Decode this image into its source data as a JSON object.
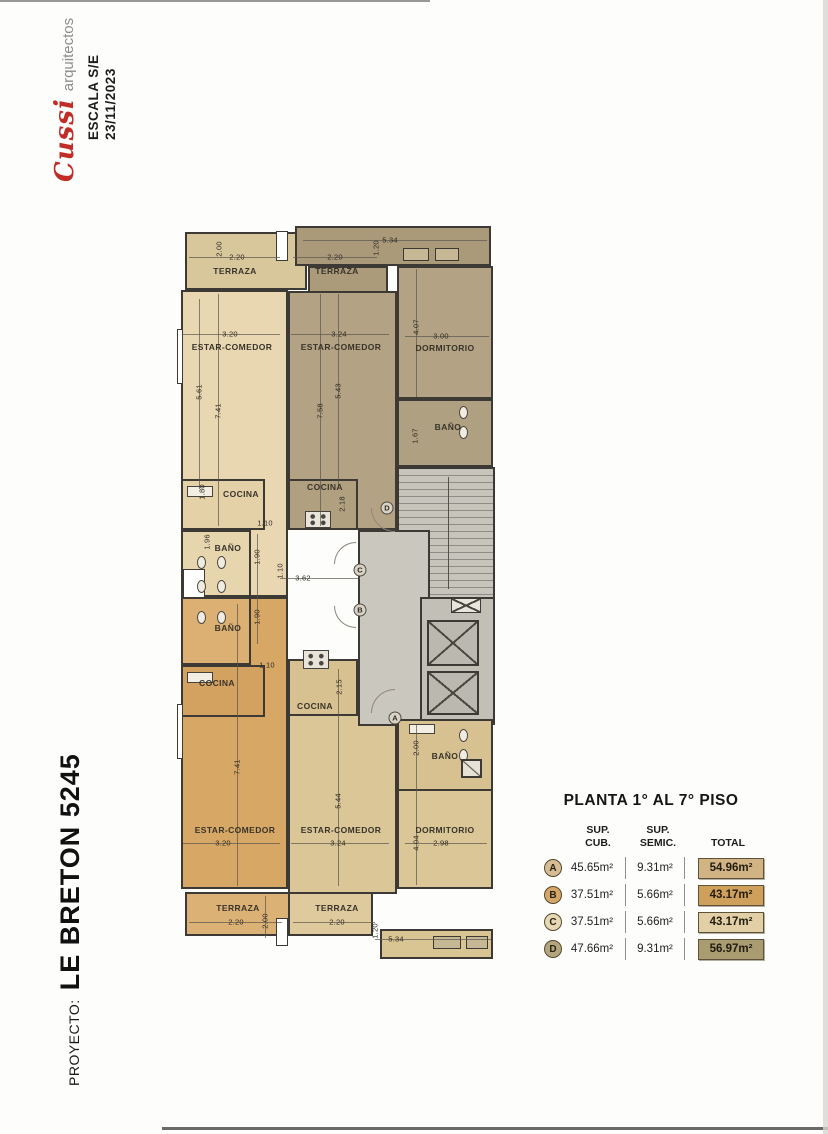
{
  "sidebar": {
    "firm_script": "Cussi",
    "firm_sub": "arquitectos",
    "scale": "ESCALA S/E",
    "date": "23/11/2023",
    "project_label": "PROYECTO:",
    "project_name": "LE BRETON 5245"
  },
  "summary": {
    "title": "PLANTA 1° AL 7° PISO",
    "col_headers": [
      "SUP.\nCUB.",
      "SUP.\nSEMIC.",
      "TOTAL"
    ],
    "rows": [
      {
        "unit": "A",
        "cub": "45.65m²",
        "semic": "9.31m²",
        "total": "54.96m²",
        "box_color": "#d2b384",
        "circle_color": "#d6bc92"
      },
      {
        "unit": "B",
        "cub": "37.51m²",
        "semic": "5.66m²",
        "total": "43.17m²",
        "box_color": "#cfa05b",
        "circle_color": "#d4a768"
      },
      {
        "unit": "C",
        "cub": "37.51m²",
        "semic": "5.66m²",
        "total": "43.17m²",
        "box_color": "#e2cfa6",
        "circle_color": "#e7d8b4"
      },
      {
        "unit": "D",
        "cub": "47.66m²",
        "semic": "9.31m²",
        "total": "56.97m²",
        "box_color": "#a99c71",
        "circle_color": "#b3a67e"
      }
    ]
  },
  "plan": {
    "unit_colors": {
      "A": "#dbc697",
      "B": "#d7a765",
      "C": "#e9d7b2",
      "D": "#b3a283",
      "common": "#cac7bf"
    },
    "labels": [
      {
        "t": "2.00",
        "x": 44,
        "y": 25,
        "v": 1
      },
      {
        "t": "2.20",
        "x": 62,
        "y": 33
      },
      {
        "t": "TERRAZA",
        "x": 60,
        "y": 47,
        "r": 1
      },
      {
        "t": "3.20",
        "x": 55,
        "y": 110
      },
      {
        "t": "ESTAR-COMEDOR",
        "x": 57,
        "y": 123,
        "r": 1
      },
      {
        "t": "5.61",
        "x": 24,
        "y": 168,
        "v": 1
      },
      {
        "t": "7.41",
        "x": 43,
        "y": 187,
        "v": 1
      },
      {
        "t": "1.80",
        "x": 27,
        "y": 268,
        "v": 1
      },
      {
        "t": "COCINA",
        "x": 66,
        "y": 270,
        "r": 1
      },
      {
        "t": "1.10",
        "x": 90,
        "y": 299
      },
      {
        "t": "1.96",
        "x": 32,
        "y": 318,
        "v": 1
      },
      {
        "t": "BAÑO",
        "x": 53,
        "y": 324,
        "r": 1
      },
      {
        "t": "1.90",
        "x": 82,
        "y": 333,
        "v": 1
      },
      {
        "t": "5.34",
        "x": 215,
        "y": 16
      },
      {
        "t": "1.20",
        "x": 201,
        "y": 24,
        "v": 1
      },
      {
        "t": "2.20",
        "x": 160,
        "y": 33
      },
      {
        "t": "TERRAZA",
        "x": 162,
        "y": 47,
        "r": 1
      },
      {
        "t": "3.24",
        "x": 164,
        "y": 110
      },
      {
        "t": "ESTAR-COMEDOR",
        "x": 166,
        "y": 123,
        "r": 1
      },
      {
        "t": "5.43",
        "x": 163,
        "y": 167,
        "v": 1
      },
      {
        "t": "7.58",
        "x": 145,
        "y": 187,
        "v": 1
      },
      {
        "t": "4.07",
        "x": 241,
        "y": 103,
        "v": 1
      },
      {
        "t": "3.00",
        "x": 266,
        "y": 112
      },
      {
        "t": "DORMITORIO",
        "x": 270,
        "y": 124,
        "r": 1
      },
      {
        "t": "1.67",
        "x": 240,
        "y": 212,
        "v": 1
      },
      {
        "t": "BAÑO",
        "x": 273,
        "y": 203,
        "r": 1
      },
      {
        "t": "COCINA",
        "x": 150,
        "y": 263,
        "r": 1
      },
      {
        "t": "2.18",
        "x": 167,
        "y": 280,
        "v": 1
      },
      {
        "t": "1.10",
        "x": 105,
        "y": 347,
        "v": 1
      },
      {
        "t": "3.62",
        "x": 128,
        "y": 354
      },
      {
        "t": "1.90",
        "x": 82,
        "y": 393,
        "v": 1
      },
      {
        "t": "BAÑO",
        "x": 53,
        "y": 404,
        "r": 1
      },
      {
        "t": "1.10",
        "x": 92,
        "y": 441
      },
      {
        "t": "COCINA",
        "x": 42,
        "y": 459,
        "r": 1
      },
      {
        "t": "7.41",
        "x": 62,
        "y": 543,
        "v": 1
      },
      {
        "t": "ESTAR-COMEDOR",
        "x": 60,
        "y": 606,
        "r": 1
      },
      {
        "t": "3.20",
        "x": 48,
        "y": 619
      },
      {
        "t": "TERRAZA",
        "x": 63,
        "y": 684,
        "r": 1
      },
      {
        "t": "2.20",
        "x": 61,
        "y": 698
      },
      {
        "t": "2.00",
        "x": 90,
        "y": 697,
        "v": 1
      },
      {
        "t": "COCINA",
        "x": 140,
        "y": 482,
        "r": 1
      },
      {
        "t": "2.15",
        "x": 164,
        "y": 463,
        "v": 1
      },
      {
        "t": "5.44",
        "x": 163,
        "y": 577,
        "v": 1
      },
      {
        "t": "ESTAR-COMEDOR",
        "x": 166,
        "y": 606,
        "r": 1
      },
      {
        "t": "3.24",
        "x": 163,
        "y": 619
      },
      {
        "t": "2.00",
        "x": 241,
        "y": 524,
        "v": 1
      },
      {
        "t": "BAÑO",
        "x": 270,
        "y": 532,
        "r": 1
      },
      {
        "t": "4.04",
        "x": 241,
        "y": 619,
        "v": 1
      },
      {
        "t": "2.98",
        "x": 266,
        "y": 619
      },
      {
        "t": "DORMITORIO",
        "x": 270,
        "y": 606,
        "r": 1
      },
      {
        "t": "TERRAZA",
        "x": 162,
        "y": 684,
        "r": 1
      },
      {
        "t": "2.20",
        "x": 162,
        "y": 698
      },
      {
        "t": "1.20",
        "x": 200,
        "y": 707,
        "v": 1
      },
      {
        "t": "5.34",
        "x": 221,
        "y": 715
      }
    ],
    "markers": [
      {
        "letter": "D",
        "x": 212,
        "y": 284
      },
      {
        "letter": "C",
        "x": 185,
        "y": 346
      },
      {
        "letter": "B",
        "x": 185,
        "y": 386
      },
      {
        "letter": "A",
        "x": 220,
        "y": 494
      }
    ]
  }
}
